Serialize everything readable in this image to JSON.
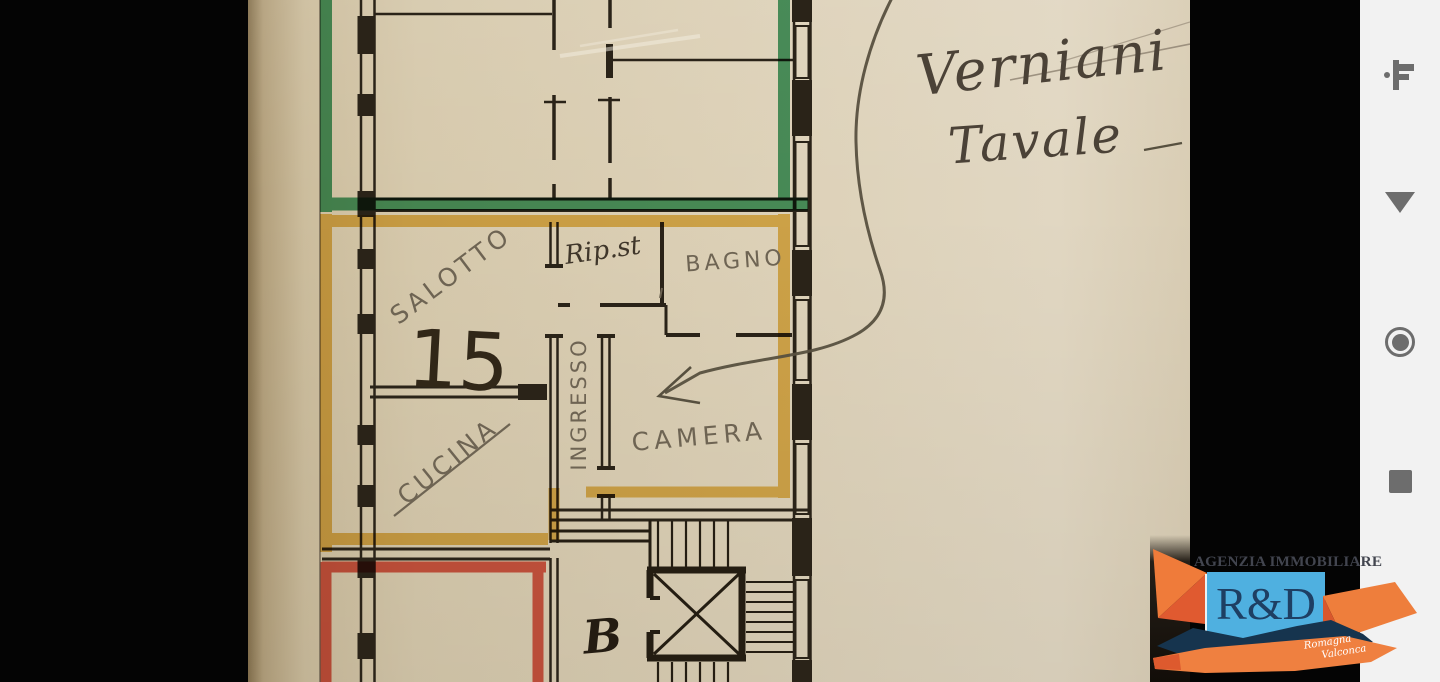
{
  "floor_plan": {
    "labels": {
      "salotto": "SALOTTO",
      "room_number": "15",
      "ripostiglio": "Rip.st",
      "bagno": "BAGNO",
      "ingresso": "INGRESSO",
      "camera": "CAMERA",
      "cucina": "CUCINA",
      "stair_letter": "B"
    },
    "note": {
      "line1": "Verniani",
      "line2": "Tavale"
    },
    "highlight_colors": {
      "upper_unit_green": "#2b9457",
      "subject_unit_yellow": "#e8b73f",
      "lower_unit_red": "#e14330"
    }
  },
  "nav_sidebar": {
    "icons": [
      "key",
      "back-triangle",
      "home-circle",
      "recents-square"
    ],
    "icon_color": "#6d6d6d",
    "background": "#f2f2f2"
  },
  "watermark": {
    "agency_name": "AGENZIA IMMOBILIARE",
    "logo_initials": "R&D",
    "tagline_line1": "Romagna",
    "tagline_line2": "Valconca",
    "colors": {
      "blue": "#4fb0e0",
      "orange": "#ef7f3c",
      "navy": "#16344e"
    }
  }
}
